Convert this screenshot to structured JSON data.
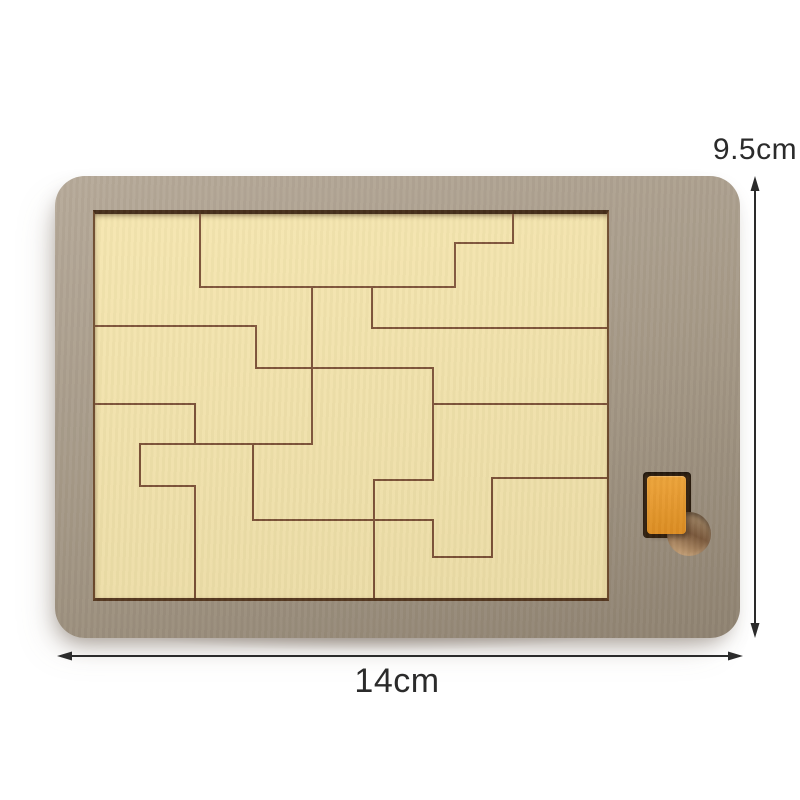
{
  "annotations": {
    "height_label": "9.5cm",
    "width_label": "14cm"
  },
  "colors": {
    "background": "#ffffff",
    "board": "#a89b88",
    "board_light": "#b3a695",
    "board_dark": "#978a78",
    "tray_cream": "#f7e7ae",
    "tray_edge_top": "#3e2511",
    "tray_edge_side": "#6e4a2b",
    "tray_edge_bottom": "#55371e",
    "piece_line": "#7d5136",
    "recess_dark": "#34220f",
    "orange_piece": "#f4a637",
    "orange_piece_dark": "#e69322",
    "hole_tan": "#cda67a",
    "hole_mid": "#a98e6c",
    "hole_shadow": "#7d5a3c",
    "annotation_ink": "#2b2b2b"
  },
  "puzzle": {
    "tray_size": {
      "width": 512,
      "height": 384
    },
    "segments": [
      {
        "x1": 105,
        "y1": 0,
        "x2": 105,
        "y2": 73
      },
      {
        "x1": 105,
        "y1": 73,
        "x2": 360,
        "y2": 73
      },
      {
        "x1": 360,
        "y1": 29,
        "x2": 360,
        "y2": 73
      },
      {
        "x1": 360,
        "y1": 29,
        "x2": 418,
        "y2": 29
      },
      {
        "x1": 418,
        "y1": 0,
        "x2": 418,
        "y2": 29
      },
      {
        "x1": 277,
        "y1": 73,
        "x2": 277,
        "y2": 114
      },
      {
        "x1": 277,
        "y1": 114,
        "x2": 512,
        "y2": 114
      },
      {
        "x1": 0,
        "y1": 112,
        "x2": 161,
        "y2": 112
      },
      {
        "x1": 161,
        "y1": 112,
        "x2": 161,
        "y2": 154
      },
      {
        "x1": 161,
        "y1": 154,
        "x2": 338,
        "y2": 154
      },
      {
        "x1": 217,
        "y1": 73,
        "x2": 217,
        "y2": 230
      },
      {
        "x1": 0,
        "y1": 190,
        "x2": 100,
        "y2": 190
      },
      {
        "x1": 100,
        "y1": 190,
        "x2": 100,
        "y2": 230
      },
      {
        "x1": 45,
        "y1": 230,
        "x2": 217,
        "y2": 230
      },
      {
        "x1": 45,
        "y1": 230,
        "x2": 45,
        "y2": 272
      },
      {
        "x1": 45,
        "y1": 272,
        "x2": 100,
        "y2": 272
      },
      {
        "x1": 100,
        "y1": 272,
        "x2": 100,
        "y2": 384
      },
      {
        "x1": 158,
        "y1": 230,
        "x2": 158,
        "y2": 306
      },
      {
        "x1": 158,
        "y1": 306,
        "x2": 338,
        "y2": 306
      },
      {
        "x1": 279,
        "y1": 266,
        "x2": 279,
        "y2": 384
      },
      {
        "x1": 279,
        "y1": 266,
        "x2": 338,
        "y2": 266
      },
      {
        "x1": 338,
        "y1": 154,
        "x2": 338,
        "y2": 266
      },
      {
        "x1": 338,
        "y1": 190,
        "x2": 512,
        "y2": 190
      },
      {
        "x1": 338,
        "y1": 306,
        "x2": 338,
        "y2": 343
      },
      {
        "x1": 338,
        "y1": 343,
        "x2": 397,
        "y2": 343
      },
      {
        "x1": 397,
        "y1": 264,
        "x2": 397,
        "y2": 343
      },
      {
        "x1": 397,
        "y1": 264,
        "x2": 512,
        "y2": 264
      }
    ]
  }
}
